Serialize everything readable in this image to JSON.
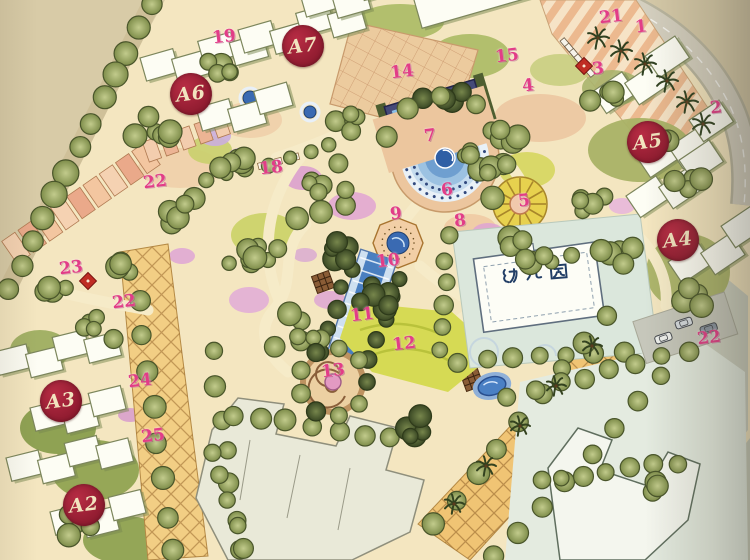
{
  "plan": {
    "title": "residential community master plan",
    "building_markers": [
      {
        "label": "A6",
        "x": 191,
        "y": 94
      },
      {
        "label": "A7",
        "x": 303,
        "y": 46
      },
      {
        "label": "A5",
        "x": 648,
        "y": 142
      },
      {
        "label": "A4",
        "x": 678,
        "y": 240
      },
      {
        "label": "A3",
        "x": 61,
        "y": 401
      },
      {
        "label": "A2",
        "x": 84,
        "y": 505
      }
    ],
    "point_labels": [
      {
        "label": "1",
        "x": 641,
        "y": 27
      },
      {
        "label": "2",
        "x": 716,
        "y": 108
      },
      {
        "label": "3",
        "x": 598,
        "y": 69
      },
      {
        "label": "4",
        "x": 528,
        "y": 86
      },
      {
        "label": "5",
        "x": 524,
        "y": 201
      },
      {
        "label": "6",
        "x": 447,
        "y": 190
      },
      {
        "label": "7",
        "x": 430,
        "y": 136
      },
      {
        "label": "8",
        "x": 460,
        "y": 221
      },
      {
        "label": "9",
        "x": 396,
        "y": 214
      },
      {
        "label": "10",
        "x": 388,
        "y": 261
      },
      {
        "label": "11",
        "x": 362,
        "y": 315
      },
      {
        "label": "12",
        "x": 404,
        "y": 344
      },
      {
        "label": "13",
        "x": 333,
        "y": 371
      },
      {
        "label": "14",
        "x": 402,
        "y": 72
      },
      {
        "label": "15",
        "x": 507,
        "y": 56
      },
      {
        "label": "18",
        "x": 271,
        "y": 168
      },
      {
        "label": "19",
        "x": 224,
        "y": 37
      },
      {
        "label": "21",
        "x": 611,
        "y": 17
      },
      {
        "label": "22",
        "x": 155,
        "y": 182
      },
      {
        "label": "22",
        "x": 124,
        "y": 302
      },
      {
        "label": "22",
        "x": 709,
        "y": 338
      },
      {
        "label": "23",
        "x": 71,
        "y": 268
      },
      {
        "label": "24",
        "x": 140,
        "y": 381
      },
      {
        "label": "25",
        "x": 153,
        "y": 436
      }
    ],
    "area_labels": [
      {
        "label": "幼儿园",
        "x": 533,
        "y": 279
      }
    ],
    "colors": {
      "paper": "#d8cba7",
      "marker_bg": "#9e1f33",
      "marker_text": "#f2e4bf",
      "point_label": "#e23d87",
      "area_label": "#223e66",
      "water": "#3a6ab2",
      "tree": "#a3b171",
      "lawn": "#9cab5e",
      "plaza": "#eccb9e",
      "boulevard": "#f0c474"
    }
  }
}
